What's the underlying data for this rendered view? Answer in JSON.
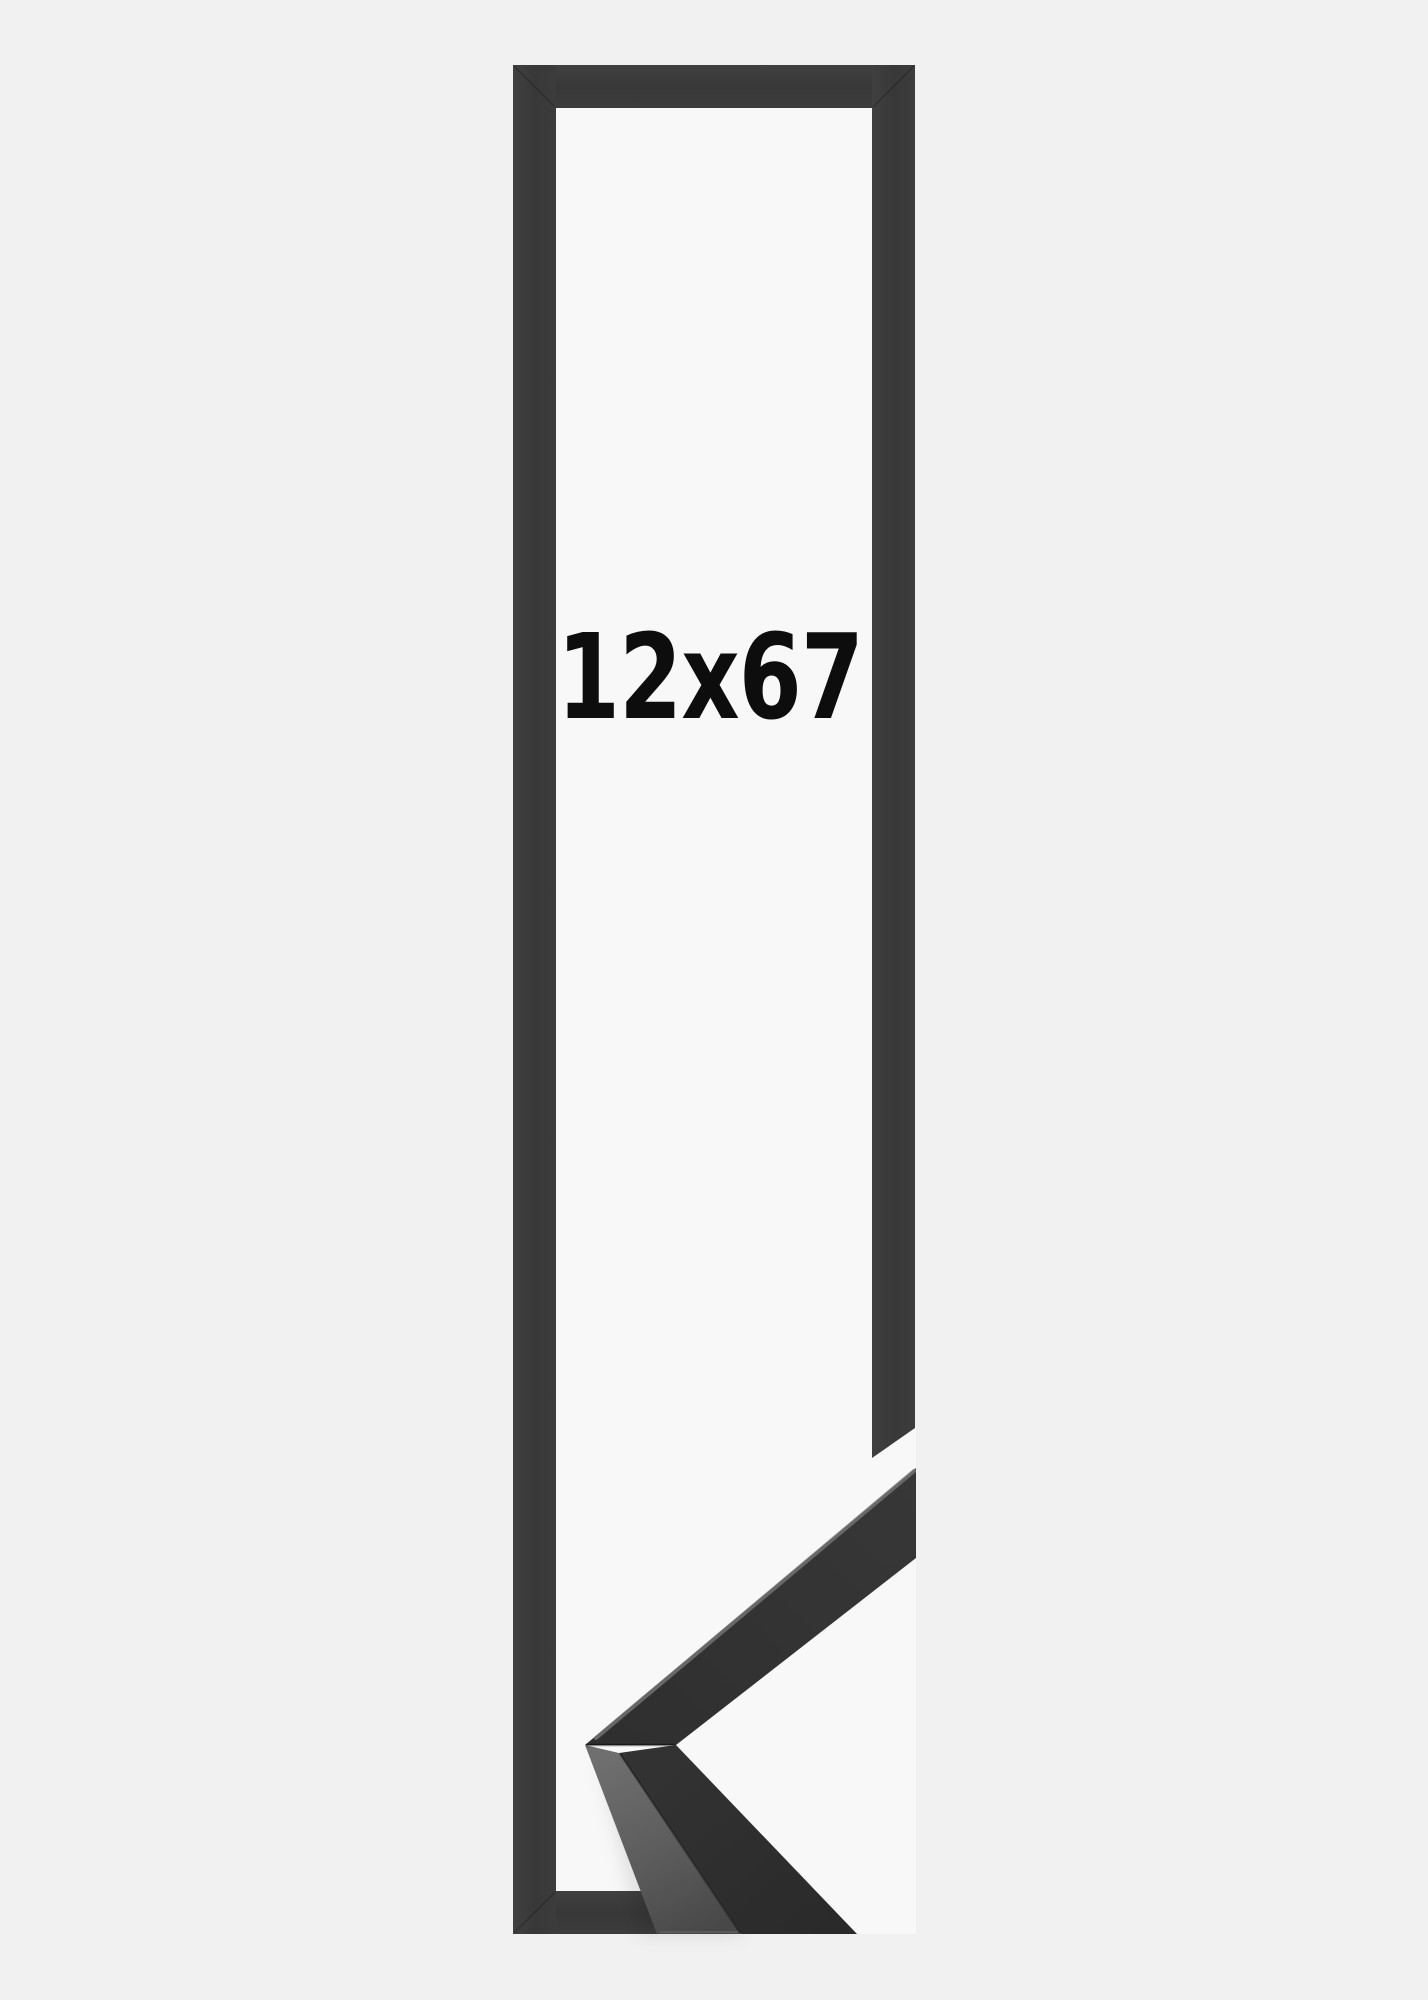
{
  "page": {
    "background_color": "#f1f1f2"
  },
  "product_image": {
    "size_label": "12x67",
    "label_color": "#0d0d0d",
    "frame_outline": {
      "bar_color": "#3a3a3a",
      "opening_color": "#f8f8f8"
    },
    "corner_profile_photo": {
      "upper_arm_color": "#333333",
      "lower_arm_front_color": "#2d2d2d",
      "side_face_top_color": "#6f6f6f",
      "side_face_bottom_color": "#484848",
      "edge_highlight_color": "#757575"
    }
  }
}
